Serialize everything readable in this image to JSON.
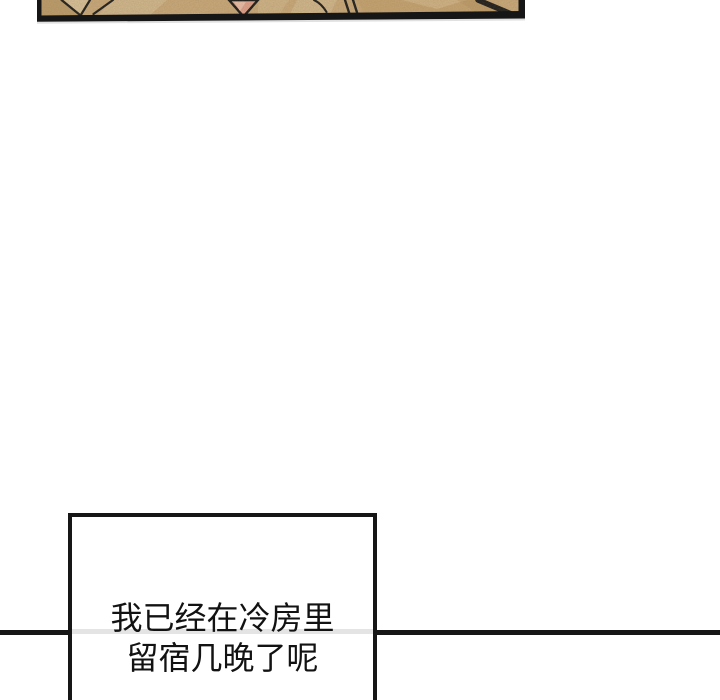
{
  "page": {
    "background_color": "#ffffff"
  },
  "comic_panel": {
    "colors": {
      "outline": "#161616",
      "tan_base": "#cbab7c",
      "tan_light": "#ddc79e",
      "tan_dark": "#b4935f",
      "tan_gold": "#c8a471",
      "pink": "#e2a28c",
      "pink_light": "#f1c7b3"
    }
  },
  "divider": {
    "color": "#161616"
  },
  "speech_box": {
    "lines": [
      "我已经在冷房里",
      "留宿几晚了呢"
    ],
    "border_color": "#161616",
    "background_color": "#ffffff",
    "text_color": "#121212",
    "inner_divider_color": "#e4e4e4"
  }
}
